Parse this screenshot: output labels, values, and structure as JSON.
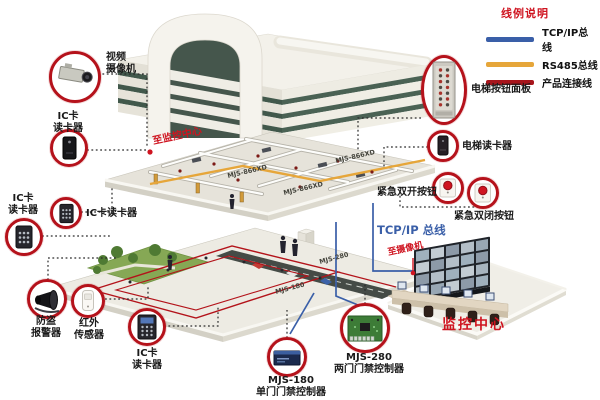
{
  "legend": {
    "title": "线例说明",
    "items": [
      {
        "name": "tcpip-bus-line",
        "label": "TCP/IP总线",
        "color": "#3a5fa8"
      },
      {
        "name": "rs485-bus-line",
        "label": "RS485总线",
        "color": "#e6a63a"
      },
      {
        "name": "product-connect-line",
        "label": "产品连接线",
        "color": "#a8151c"
      }
    ]
  },
  "devices": {
    "video_camera": {
      "line1": "视频",
      "line2": "摄像机"
    },
    "ic_reader_top": {
      "line1": "IC卡",
      "line2": "读卡器"
    },
    "ic_reader_left": {
      "line1": "IC卡",
      "line2": "读卡器"
    },
    "ic_reader_mid": {
      "label": "IC卡读卡器"
    },
    "burglar_alarm": {
      "line1": "防盗",
      "line2": "报警器"
    },
    "ir_sensor": {
      "line1": "红外",
      "line2": "传感器"
    },
    "ic_reader_bottom": {
      "line1": "IC卡",
      "line2": "读卡器"
    },
    "mjs180": {
      "line1": "MJS-180",
      "line2": "单门门禁控制器"
    },
    "mjs280": {
      "line1": "MJS-280",
      "line2": "两门门禁控制器"
    },
    "elevator_panel": {
      "label": "电梯按钮面板"
    },
    "elevator_reader": {
      "label": "电梯读卡器"
    },
    "emergency_open": {
      "label": "紧急双开按钮"
    },
    "emergency_close": {
      "label": "紧急双闭按钮"
    }
  },
  "annotations": {
    "to_monitoring_center": "至监控中心",
    "to_camera": "至摄像机",
    "tcpip_bus": "TCP/IP 总线",
    "monitoring_center": "监控中心",
    "controller_1": "MJS-866XD",
    "controller_2": "MJS-866XD",
    "controller_3": "MJS-866XD",
    "controller_4": "MJS-280",
    "controller_5": "MJS-180"
  }
}
